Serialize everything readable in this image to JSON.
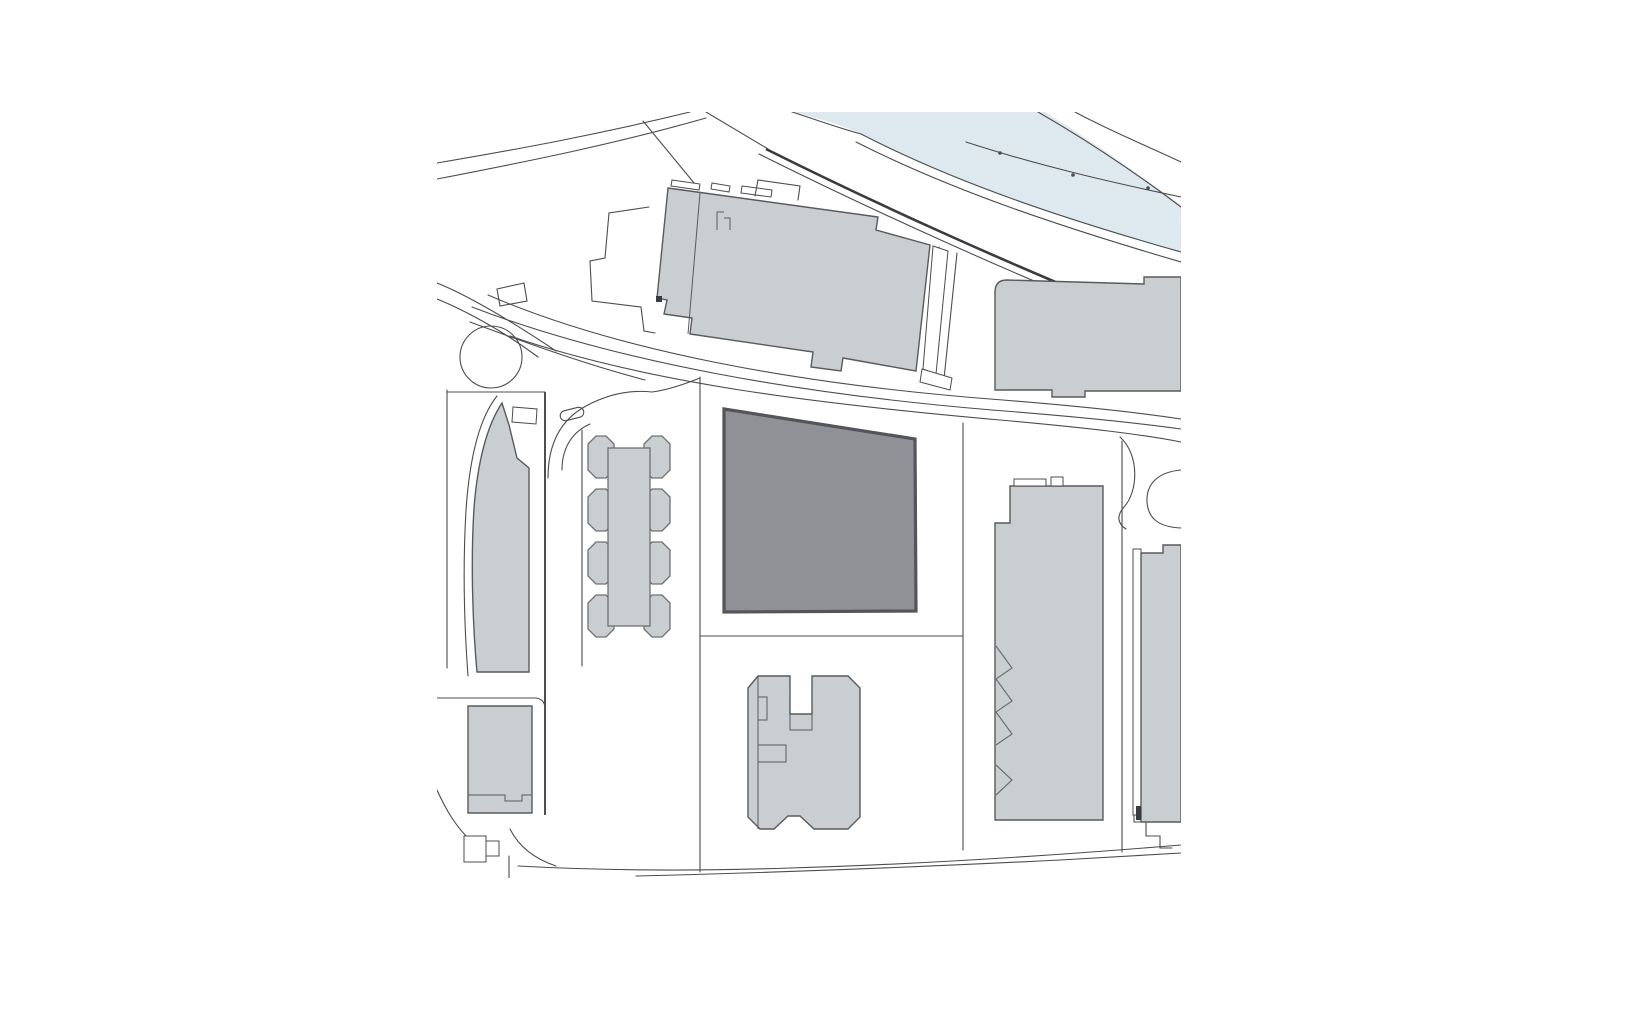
{
  "title": "Architectural site plan",
  "colors": {
    "background": "#ffffff",
    "line": "#4b4c50",
    "line_dark": "#3a3b3e",
    "river_fill": "#dde9ee",
    "building_fill": "#cbced1",
    "building_outline": "#595a5e",
    "detail_line": "#6e7074",
    "site_fill": "#8f9196",
    "site_outline": "#54555b"
  },
  "elements": [
    {
      "name": "river",
      "role": "watercourse band, top right"
    },
    {
      "name": "site-building",
      "role": "highlighted proposed building footprint, dark grey"
    },
    {
      "name": "context-buildings",
      "role": "existing building footprints, light grey"
    },
    {
      "name": "roundabout",
      "role": "circular road feature, left"
    },
    {
      "name": "road-network",
      "role": "street and parcel boundary linework"
    }
  ]
}
